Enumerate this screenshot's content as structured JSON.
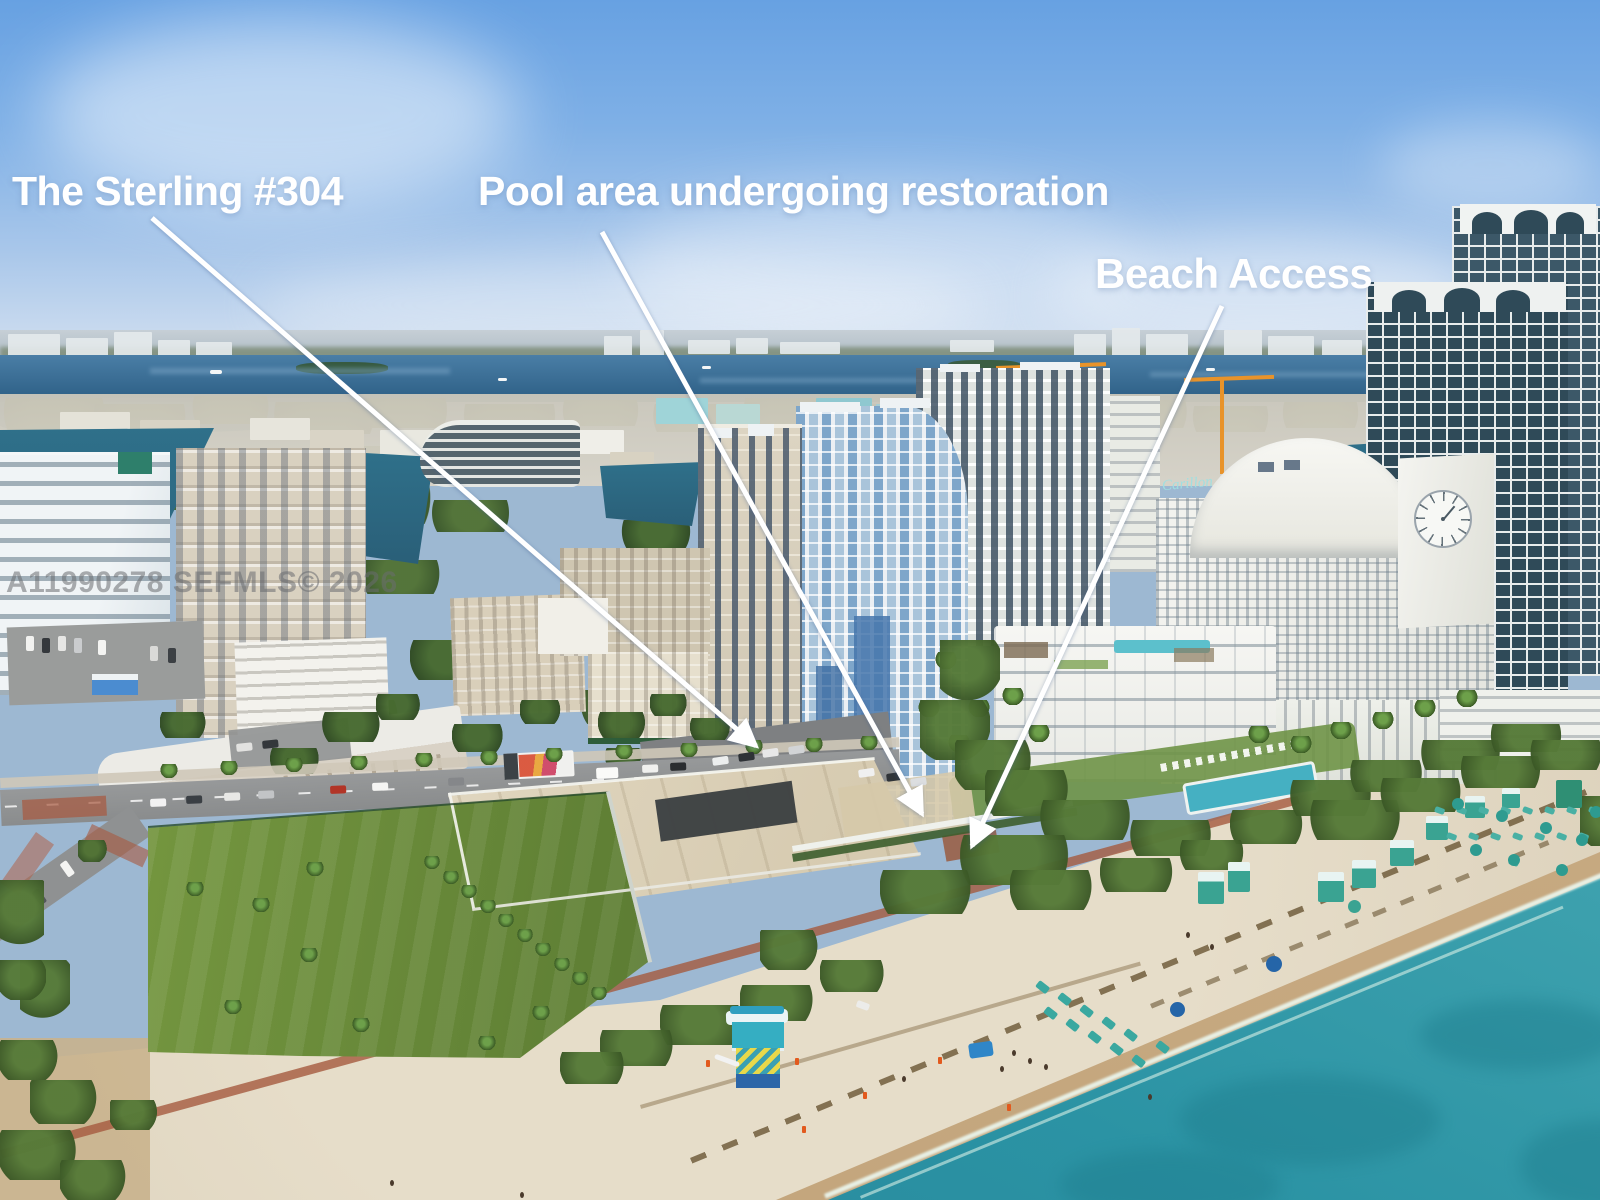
{
  "annotations": {
    "sterling_label": "The Sterling #304",
    "pool_label": "Pool area undergoing restoration",
    "beach_access_label": "Beach Access"
  },
  "watermark_text": "A11990278  SEFMLS© 2026",
  "building_signs": {
    "carillon_script": "Carillon"
  },
  "colors": {
    "annotation_text": "#ffffff",
    "watermark_gray": "rgba(105,108,112,0.55)",
    "sky_blue": "#67a1e2",
    "bay_blue": "#2c5e84",
    "ocean_teal": "#2b93a4",
    "sand": "#ddd2bc",
    "grass_green": "#6b8d3f",
    "beach_furniture_teal": "#3aa8a0",
    "crane_orange": "#e8932a"
  }
}
